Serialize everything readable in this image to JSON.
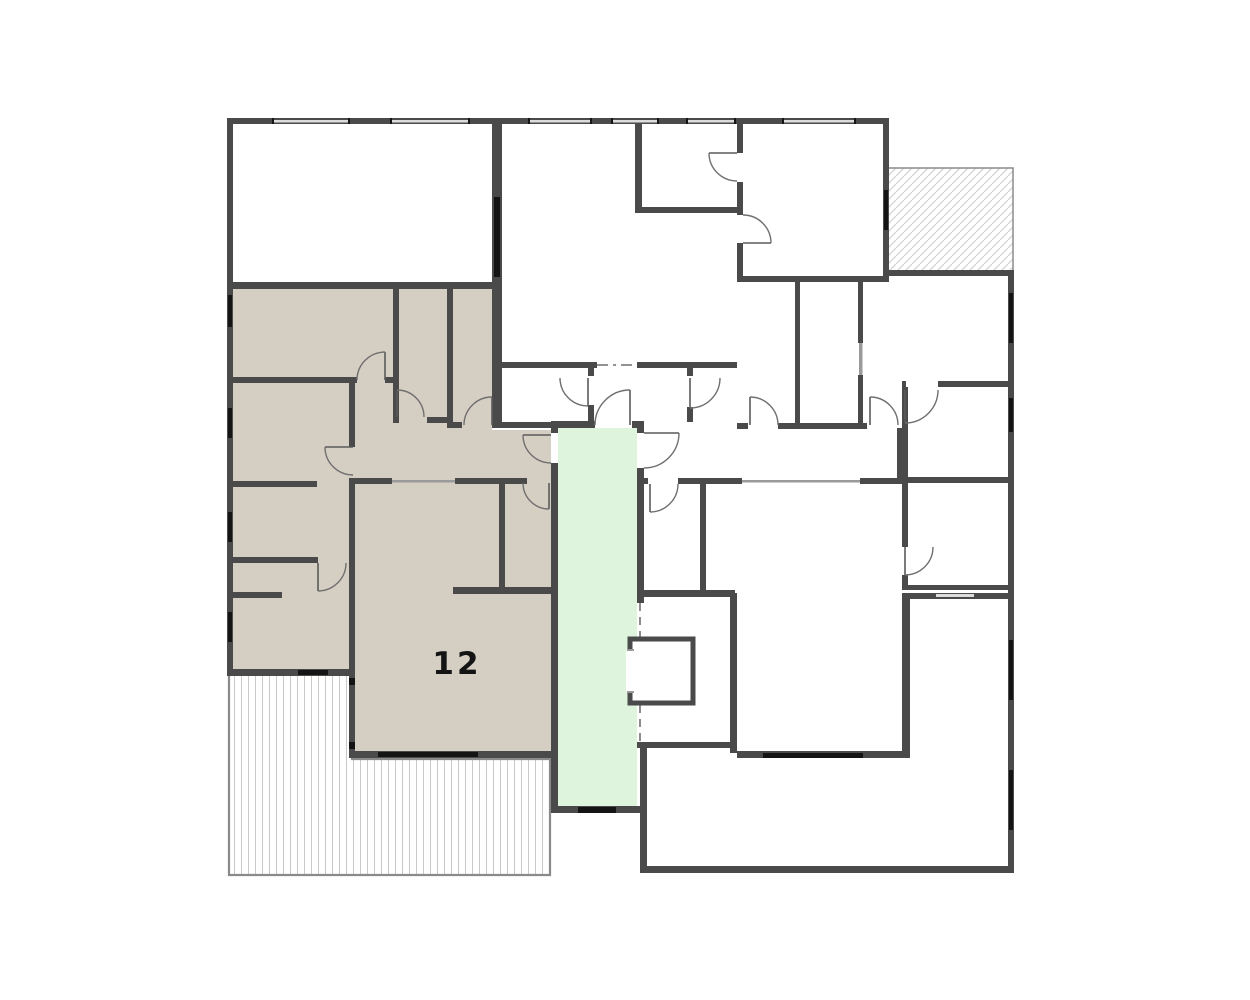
{
  "floor_plan": {
    "unit_label": "12",
    "colors": {
      "highlighted_unit_fill": "#d5cfc3",
      "stair_lobby_fill": "#def4dc",
      "wall": "#4a4a4a",
      "door_arc": "#6f6f6f",
      "terrace_hatch_line": "#c9c9c9",
      "balcony_hatch_line": "#d2d2d2",
      "hatch_border": "#8a8a8a",
      "window_mark": "#141414",
      "label_text": "#141414"
    }
  }
}
